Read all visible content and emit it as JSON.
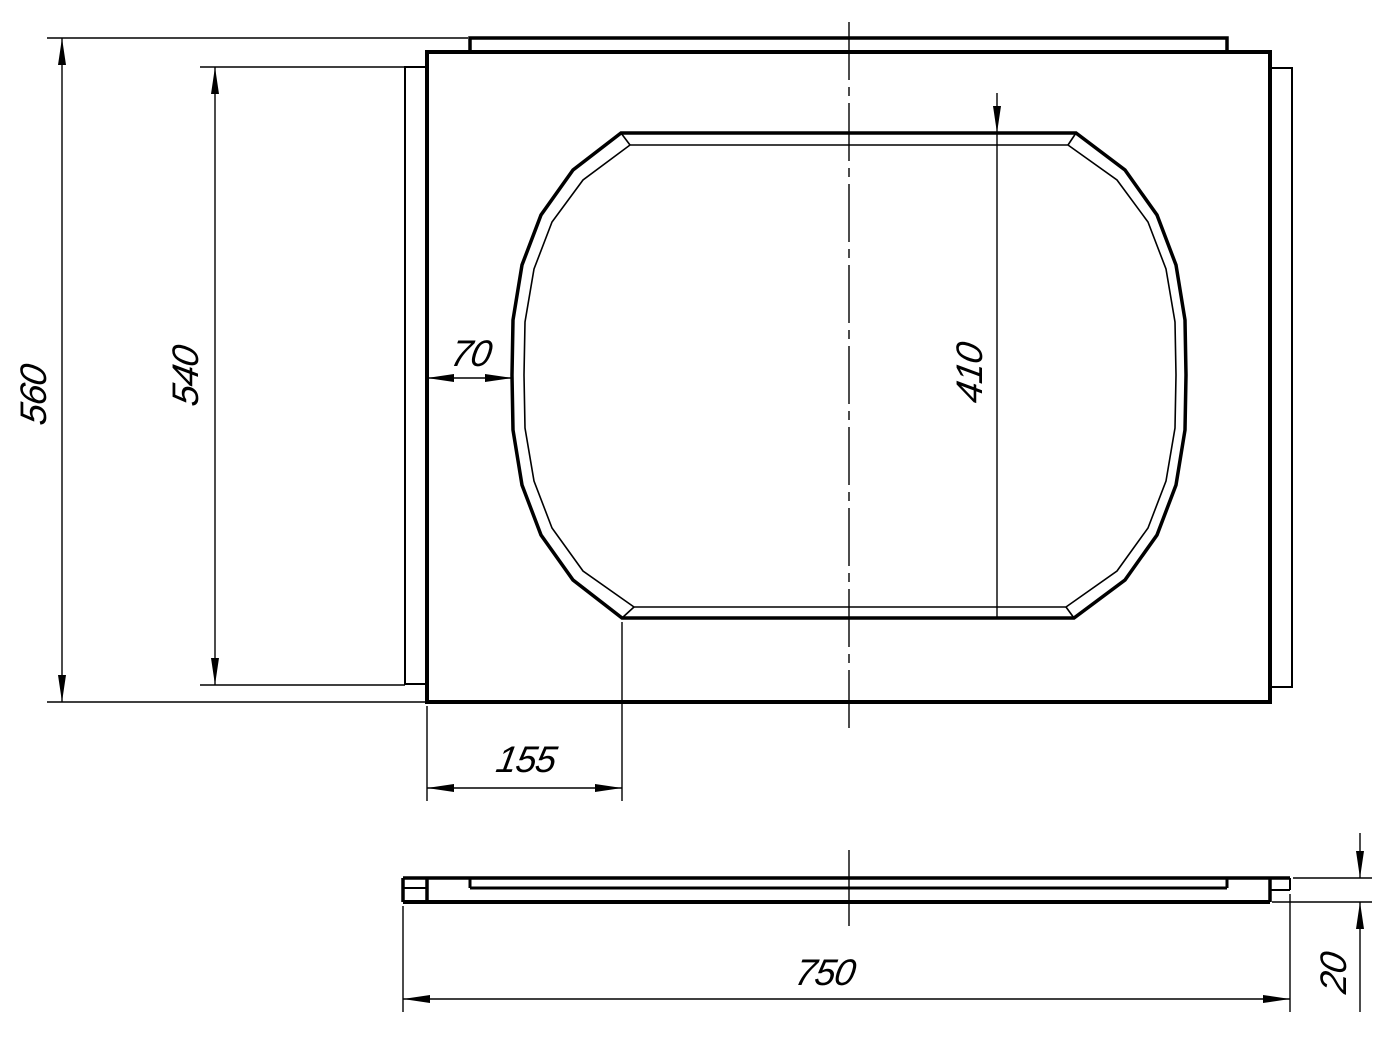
{
  "drawing": {
    "background_color": "#ffffff",
    "line_color": "#000000",
    "views": {
      "plan_view": "plate-with-oval-cutout",
      "side_view": "thin-slab-profile"
    },
    "dims": {
      "overall_height": "560",
      "side_tab_height": "540",
      "cutout_side_offset": "70",
      "cutout_height": "410",
      "cutout_corner_offset": "155",
      "overall_width": "750",
      "plate_thickness": "20"
    }
  }
}
